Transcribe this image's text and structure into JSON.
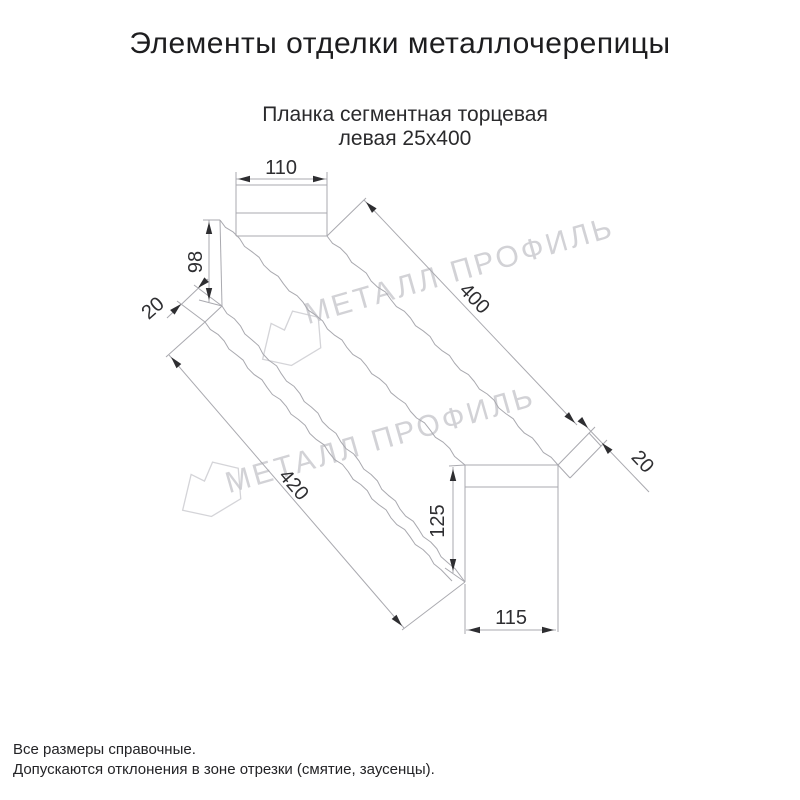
{
  "title": "Элементы отделки металлочерепицы",
  "subtitle": {
    "line1": "Планка сегментная торцевая",
    "line2": "левая 25х400"
  },
  "drawing": {
    "name": "Планка сегментная торцевая левая 25х400",
    "dimensions": {
      "top_flange_width": "110",
      "side_height": "98",
      "left_hem": "20",
      "top_length": "400",
      "end_fold": "20",
      "bottom_length": "420",
      "end_cap_height": "125",
      "end_cap_width": "115"
    }
  },
  "watermark": {
    "text": "МЕТАЛЛ ПРОФИЛЬ",
    "logo": "metall-profil-logo"
  },
  "footer": {
    "line1": "Все размеры справочные.",
    "line2": "Допускаются отклонения в зоне отрезки (смятие, заусенцы)."
  },
  "colors": {
    "line": "#a9a9af",
    "dimension": "#2e2e31",
    "text": "#1d1d1f",
    "watermark": "#c7c7cc",
    "background": "#ffffff"
  }
}
